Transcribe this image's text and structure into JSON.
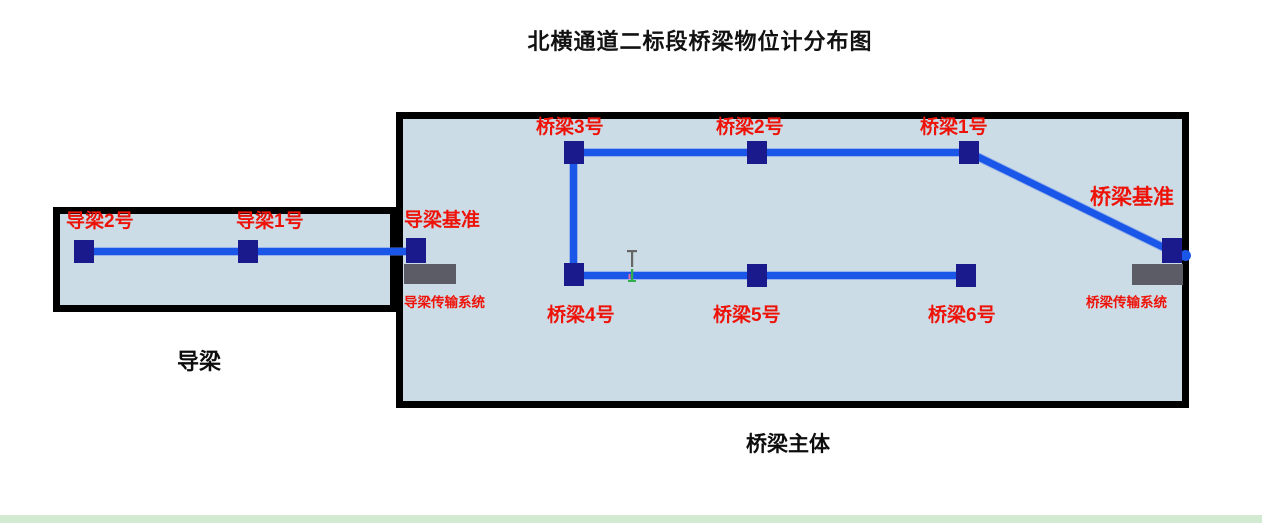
{
  "title": "北横通道二标段桥梁物位计分布图",
  "guide_beam": {
    "caption": "导梁",
    "node2": "导梁2号",
    "node1": "导梁1号",
    "base": "导梁基准",
    "transmission": "导梁传输系统"
  },
  "bridge": {
    "caption": "桥梁主体",
    "node3": "桥梁3号",
    "node2": "桥梁2号",
    "node1": "桥梁1号",
    "node4": "桥梁4号",
    "node5": "桥梁5号",
    "node6": "桥梁6号",
    "base": "桥梁基准",
    "transmission": "桥梁传输系统"
  },
  "cursor": "text-ibeam",
  "colors": {
    "line_blue": "#1a56e8",
    "node_navy": "#1a1a8c",
    "label_red": "#ee1309",
    "panel_fill": "#ccdce6",
    "panel_border": "#000000",
    "transmission_gray": "#5b5c66",
    "footer_strip_green": "#d2e9d2"
  }
}
